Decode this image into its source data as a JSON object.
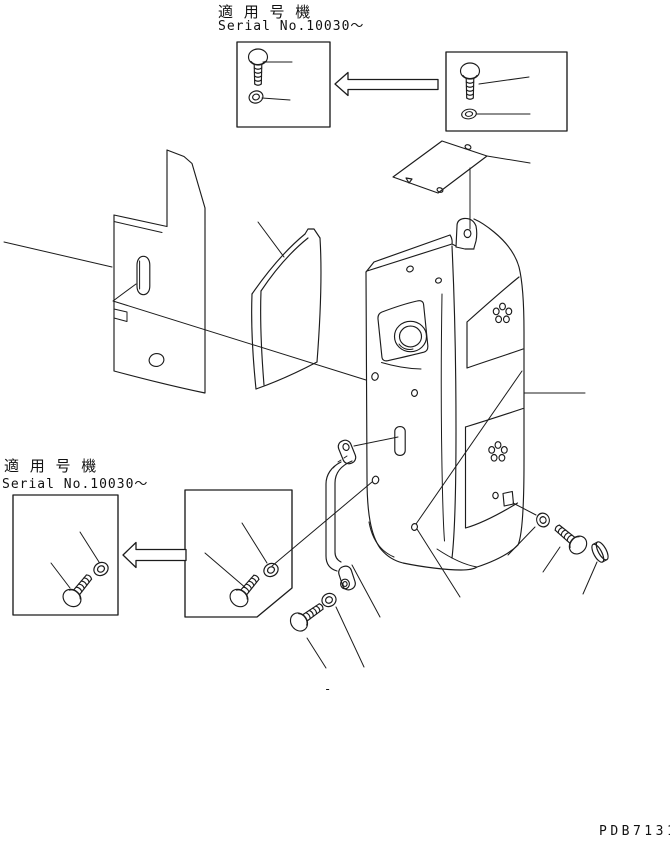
{
  "labels": {
    "top_applicable": "適 用 号 機",
    "top_serial": "Serial No.10030～",
    "bottom_applicable": "適 用 号 機",
    "bottom_serial": "Serial No.10030～",
    "drawing_code": "PDB7131",
    "center_dash": "-"
  },
  "colors": {
    "line": "#1c1c1c",
    "background": "#ffffff"
  }
}
